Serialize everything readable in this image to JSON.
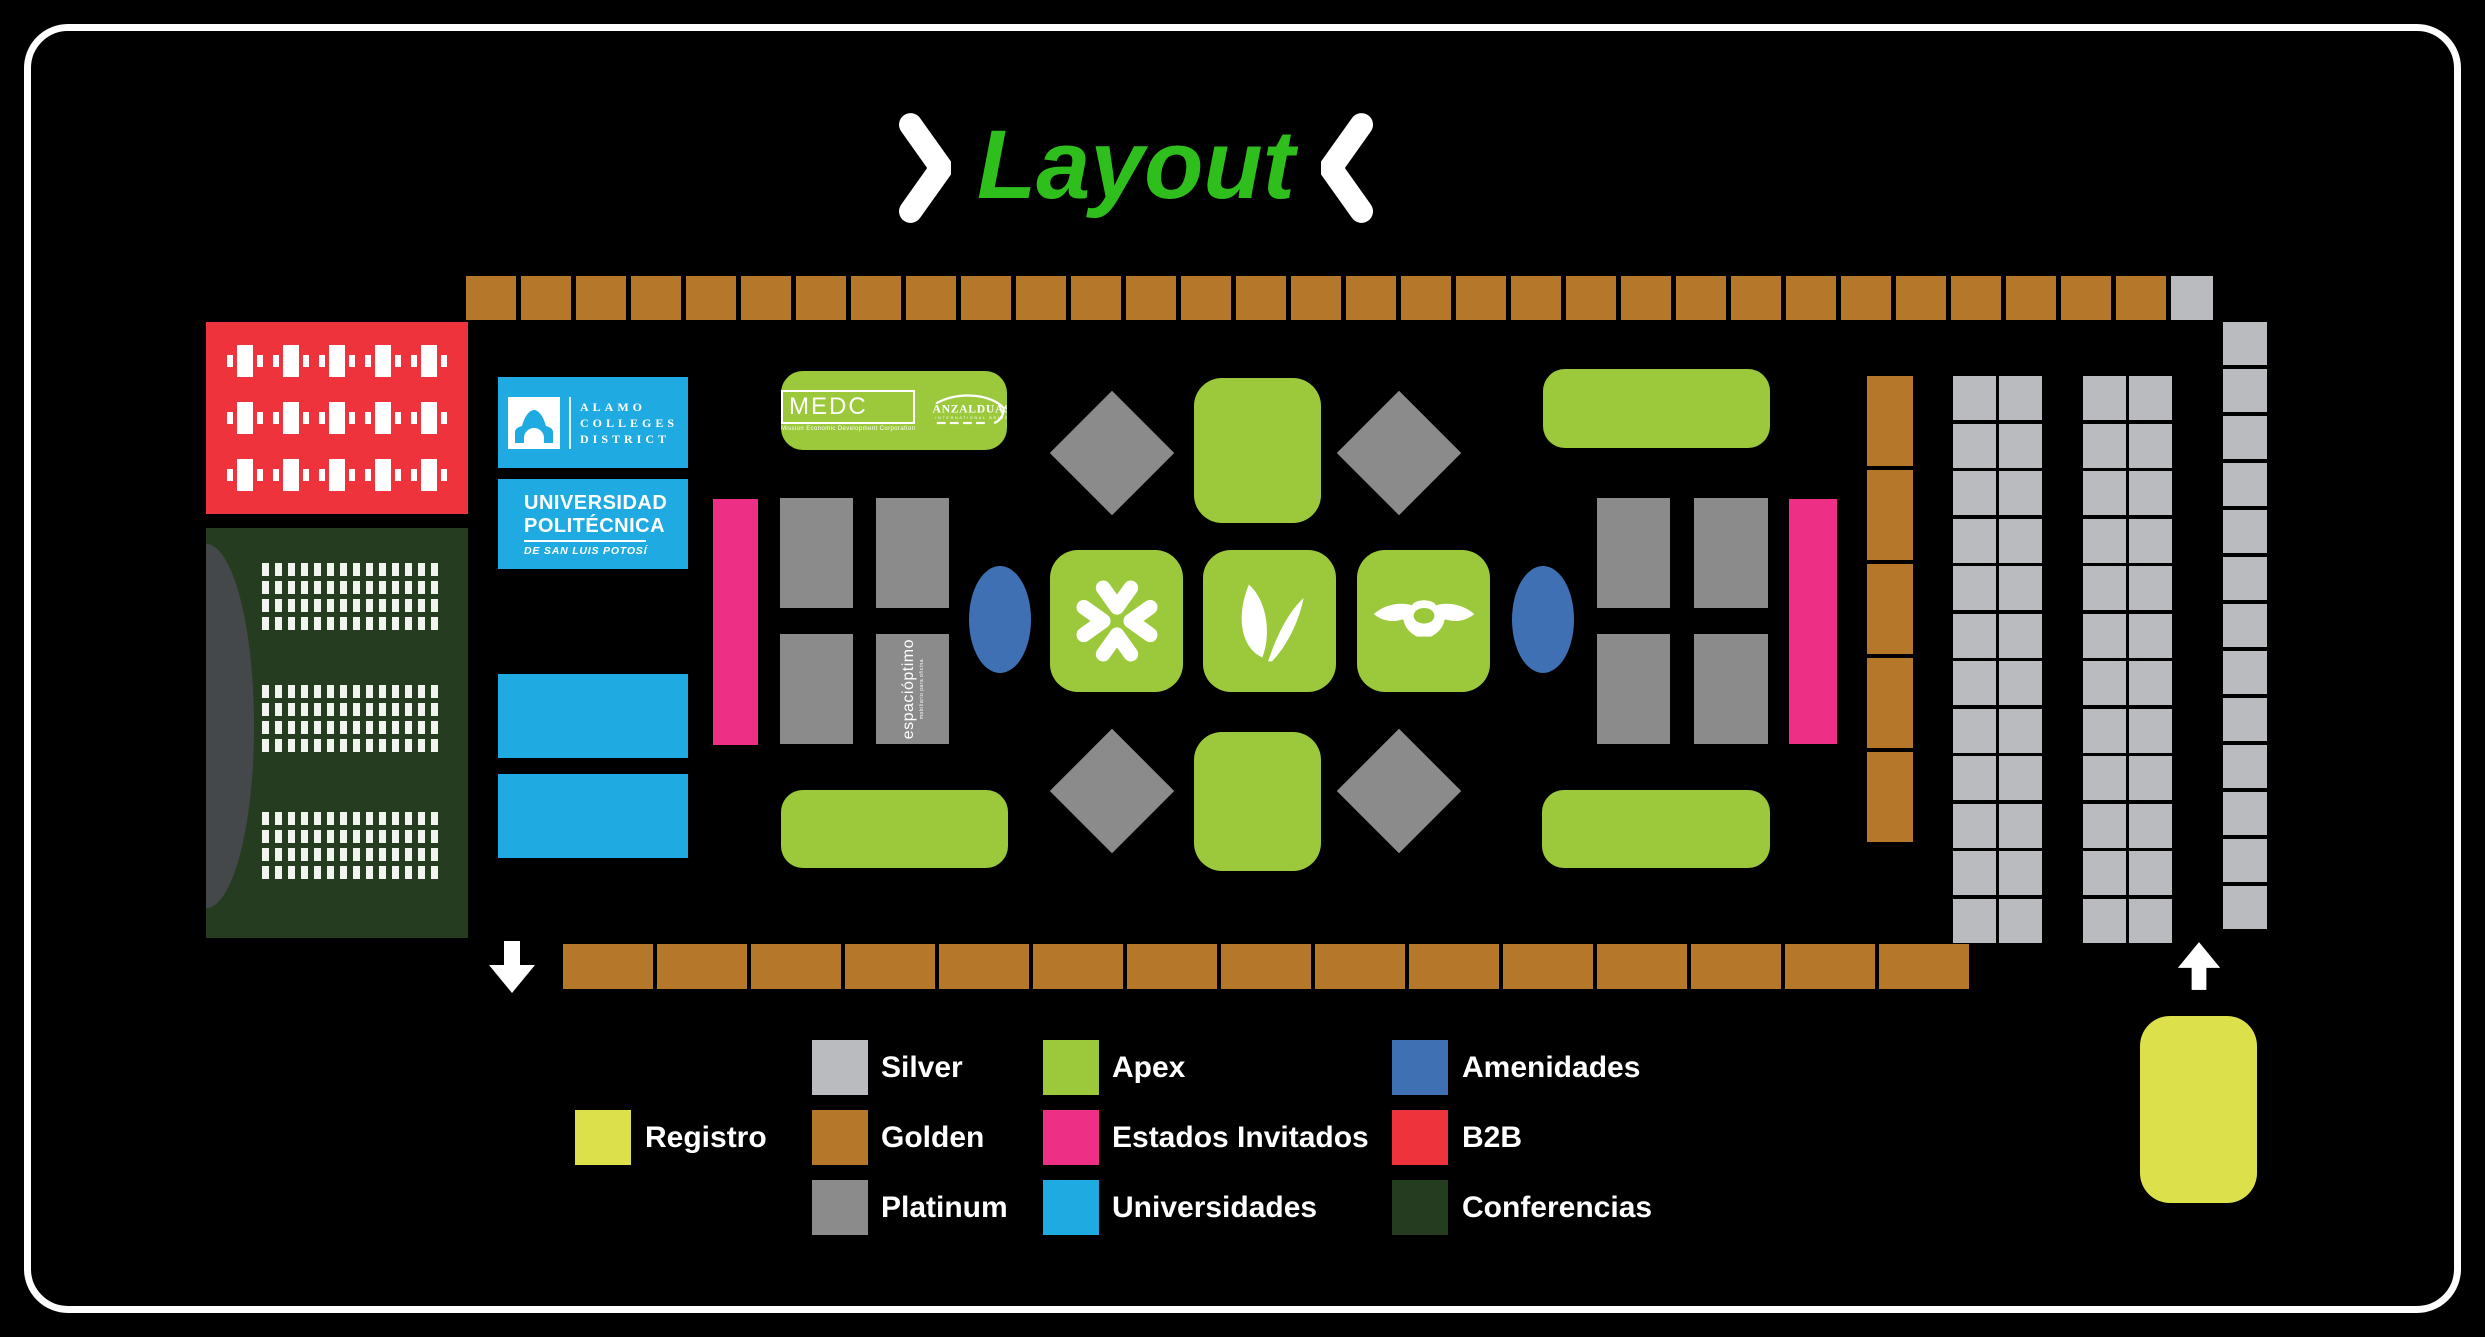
{
  "title": "Layout",
  "colors": {
    "background": "#000000",
    "frame": "#ffffff",
    "title": "#2fbf1d",
    "golden": "#b5782a",
    "silver": "#b9bbbf",
    "platinum": "#8a8b8a",
    "apex": "#9cc93c",
    "estados_invitados": "#ee2f86",
    "universidades": "#1fabe2",
    "amenidades": "#4070b4",
    "b2b": "#ee333c",
    "conferencias": "#253c21",
    "registro": "#dce04a",
    "stage": "#44484b"
  },
  "legend": {
    "columns": [
      {
        "items": [
          {
            "key": "registro",
            "label": "Registro",
            "row": 1
          }
        ]
      },
      {
        "items": [
          {
            "key": "silver",
            "label": "Silver",
            "row": 0
          },
          {
            "key": "golden",
            "label": "Golden",
            "row": 1
          },
          {
            "key": "platinum",
            "label": "Platinum",
            "row": 2
          }
        ]
      },
      {
        "items": [
          {
            "key": "apex",
            "label": "Apex",
            "row": 0
          },
          {
            "key": "estados_invitados",
            "label": "Estados Invitados",
            "row": 1
          },
          {
            "key": "universidades",
            "label": "Universidades",
            "row": 2
          }
        ]
      },
      {
        "items": [
          {
            "key": "amenidades",
            "label": "Amenidades",
            "row": 0
          },
          {
            "key": "b2b",
            "label": "B2B",
            "row": 1
          },
          {
            "key": "conferencias",
            "label": "Conferencias",
            "row": 2
          }
        ]
      }
    ]
  },
  "logos": {
    "alamo": {
      "line1": "ALAMO",
      "line2": "COLLEGES",
      "line3": "DISTRICT"
    },
    "upslp": {
      "line1": "UNIVERSIDAD",
      "line2": "POLITÉCNICA",
      "line3": "DE SAN LUIS POTOSÍ"
    },
    "medc": {
      "name": "MEDC",
      "caption": "Mission Economic Development Corporation"
    },
    "anzalduas": {
      "name": "ANZALDUAS",
      "caption": "INTERNATIONAL  BRIDGE"
    },
    "espacioptimo": {
      "name": "espacióptimo",
      "caption": "mobiliario para oficina"
    }
  },
  "grids": {
    "top_row": {
      "golden_count": 31,
      "silver_count": 1
    },
    "bottom_row": {
      "golden_count": 15
    },
    "golden_column": {
      "count": 5
    },
    "silver_grid_left": {
      "cols": 2,
      "rows": 12
    },
    "silver_grid_right": {
      "cols": 2,
      "rows": 12
    },
    "silver_strip": {
      "rows": 13
    },
    "b2b_tables": {
      "rows": 3,
      "cols": 5
    },
    "conference_blocks": {
      "count": 3,
      "rows": 4,
      "cols": 14
    }
  }
}
